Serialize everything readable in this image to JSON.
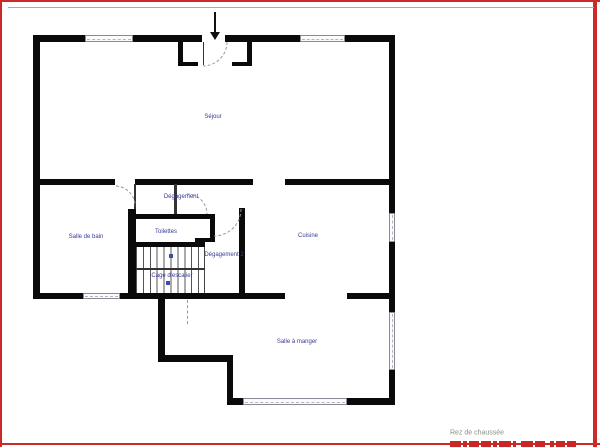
{
  "plan": {
    "floor_label": "Rez de chaussée",
    "rooms": {
      "sejour": "Séjour",
      "degagement": "Dégagement",
      "salle_de_bain": "Salle de bain",
      "toilettes": "Toilettes",
      "degagement2": "Dégagement 2",
      "cage_escalier": "Cage d'escalier",
      "cuisine": "Cuisine",
      "salle_a_manger": "Salle à manger"
    },
    "colors": {
      "wall": "#0a0a0a",
      "room_label": "#3a3a99",
      "floor_label_color": "#8c8c86",
      "frame_border": "#cc2a2a"
    }
  }
}
